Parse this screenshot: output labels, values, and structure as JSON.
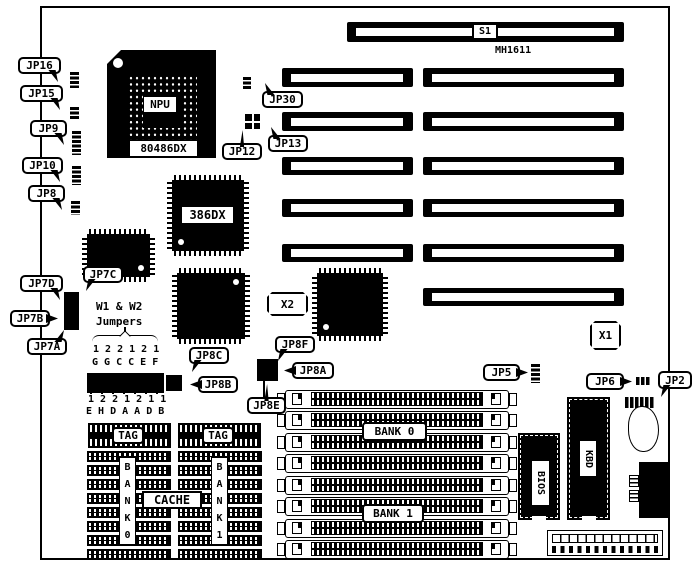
{
  "meta": {
    "description": "MH1611 486 motherboard jumper location diagram",
    "ink": "#000000",
    "paper": "#ffffff"
  },
  "board": {
    "name": "pcb-outline",
    "x": 40,
    "y": 6,
    "w": 630,
    "h": 554
  },
  "components": [
    {
      "type": "slot",
      "name": "slot-s1",
      "x": 347,
      "y": 22,
      "w": 277,
      "h": 20
    },
    {
      "type": "slot",
      "name": "slot-isa-left-1",
      "x": 282,
      "y": 68,
      "w": 131,
      "h": 19
    },
    {
      "type": "slot",
      "name": "slot-isa-right-1",
      "x": 423,
      "y": 68,
      "w": 201,
      "h": 19
    },
    {
      "type": "slot",
      "name": "slot-isa-left-2",
      "x": 282,
      "y": 112,
      "w": 131,
      "h": 19
    },
    {
      "type": "slot",
      "name": "slot-isa-right-2",
      "x": 423,
      "y": 112,
      "w": 201,
      "h": 19
    },
    {
      "type": "slot",
      "name": "slot-isa-left-3",
      "x": 282,
      "y": 157,
      "w": 131,
      "h": 18
    },
    {
      "type": "slot",
      "name": "slot-isa-right-3",
      "x": 423,
      "y": 157,
      "w": 201,
      "h": 18
    },
    {
      "type": "slot",
      "name": "slot-isa-left-4",
      "x": 282,
      "y": 199,
      "w": 131,
      "h": 18
    },
    {
      "type": "slot",
      "name": "slot-isa-right-4",
      "x": 423,
      "y": 199,
      "w": 201,
      "h": 18
    },
    {
      "type": "slot",
      "name": "slot-isa-left-5",
      "x": 282,
      "y": 244,
      "w": 131,
      "h": 18
    },
    {
      "type": "slot",
      "name": "slot-isa-right-5",
      "x": 423,
      "y": 244,
      "w": 201,
      "h": 18
    },
    {
      "type": "slot",
      "name": "slot-isa-right-6",
      "x": 423,
      "y": 288,
      "w": 201,
      "h": 18
    },
    {
      "type": "pga",
      "name": "chip-npu-socket",
      "x": 107,
      "y": 50,
      "w": 109,
      "h": 108
    },
    {
      "type": "tag",
      "name": "tag-npu",
      "label": "NPU",
      "x": 144,
      "y": 97,
      "w": 32,
      "h": 15,
      "border": 0,
      "fs": 11
    },
    {
      "type": "tag",
      "name": "tag-80486dx",
      "label": "80486DX",
      "x": 130,
      "y": 141,
      "w": 67,
      "h": 15,
      "border": 0,
      "fs": 11
    },
    {
      "type": "qfp",
      "name": "chip-386dx",
      "x": 172,
      "y": 180,
      "w": 72,
      "h": 71,
      "dot": "bl"
    },
    {
      "type": "tag",
      "name": "tag-386dx",
      "label": "386DX",
      "x": 182,
      "y": 207,
      "w": 51,
      "h": 16,
      "border": 0,
      "fs": 12
    },
    {
      "type": "qfp",
      "name": "chip-qfp-upper-left",
      "x": 87,
      "y": 234,
      "w": 63,
      "h": 43,
      "dot": "br"
    },
    {
      "type": "qfp",
      "name": "chip-qfp-center",
      "x": 177,
      "y": 273,
      "w": 68,
      "h": 66,
      "dot": "tr"
    },
    {
      "type": "qfp",
      "name": "chip-qfp-right",
      "x": 317,
      "y": 273,
      "w": 66,
      "h": 63,
      "dot": "bl"
    },
    {
      "type": "vstrip",
      "name": "jumper-jp16-pins",
      "x": 70,
      "y": 72,
      "w": 9,
      "h": 16
    },
    {
      "type": "vstrip",
      "name": "jumper-jp15-pins",
      "x": 70,
      "y": 107,
      "w": 9,
      "h": 13
    },
    {
      "type": "vstrip",
      "name": "jumper-jp9-pins",
      "x": 72,
      "y": 131,
      "w": 9,
      "h": 24
    },
    {
      "type": "vstrip",
      "name": "jumper-jp10-pins",
      "x": 72,
      "y": 166,
      "w": 9,
      "h": 19
    },
    {
      "type": "vstrip",
      "name": "jumper-jp8-pins",
      "x": 71,
      "y": 201,
      "w": 9,
      "h": 14
    },
    {
      "type": "vstrip",
      "name": "jumper-jp30-pins",
      "x": 243,
      "y": 77,
      "w": 8,
      "h": 13
    },
    {
      "type": "vstrip",
      "name": "jumper-jp5-pins",
      "x": 531,
      "y": 364,
      "w": 9,
      "h": 19
    },
    {
      "type": "hstrip",
      "name": "jumper-jp6-pins",
      "x": 636,
      "y": 377,
      "w": 15,
      "h": 8
    },
    {
      "type": "hstrip",
      "name": "jumper-jp2-pins",
      "x": 625,
      "y": 397,
      "w": 29,
      "h": 11
    },
    {
      "type": "block",
      "name": "jumper-block-jp7",
      "x": 64,
      "y": 292,
      "w": 15,
      "h": 38,
      "cols": 2,
      "rows": 6
    },
    {
      "type": "cross",
      "name": "jumper-jp12-jp13",
      "x": 245,
      "y": 114,
      "w": 15,
      "h": 15
    },
    {
      "type": "block",
      "name": "jumper-block-w1-w2",
      "x": 87,
      "y": 373,
      "w": 77,
      "h": 20,
      "cols": 12,
      "rows": 2
    },
    {
      "type": "block",
      "name": "jumper-block-jp8bc",
      "x": 166,
      "y": 375,
      "w": 16,
      "h": 16,
      "cols": 2,
      "rows": 2
    },
    {
      "type": "block",
      "name": "jumper-block-jp8aef",
      "x": 257,
      "y": 359,
      "w": 21,
      "h": 22,
      "cols": 2,
      "rows": 3
    },
    {
      "type": "bar",
      "name": "jp8e-pointer-line",
      "x": 263,
      "y": 380,
      "w": 2,
      "h": 18
    },
    {
      "type": "bar",
      "name": "jumpers-brace-stem",
      "x": 124,
      "y": 327,
      "w": 2,
      "h": 5
    },
    {
      "type": "text",
      "name": "text-w1-w2",
      "label": "W1 & W2",
      "x": 96,
      "y": 301,
      "fs": 11
    },
    {
      "type": "text",
      "name": "text-jumpers",
      "label": "Jumpers",
      "x": 96,
      "y": 316,
      "fs": 11
    },
    {
      "type": "brace",
      "name": "jumpers-brace",
      "x": 92,
      "y": 332,
      "w": 66,
      "h": 11
    },
    {
      "type": "text",
      "name": "text-top-pin-numbers",
      "label": "1 2 2 1 2 1",
      "x": 93,
      "y": 345,
      "fs": 10
    },
    {
      "type": "text",
      "name": "text-top-pin-letters",
      "label": "G G C C E F",
      "x": 92,
      "y": 358,
      "fs": 10
    },
    {
      "type": "ticks",
      "name": "w1-w2-tick-row",
      "x": 90,
      "y": 389,
      "w": 74,
      "h": 5
    },
    {
      "type": "text",
      "name": "text-bottom-pin-numbers",
      "label": "1 2 2 1 2 1 1",
      "x": 88,
      "y": 395,
      "fs": 10
    },
    {
      "type": "text",
      "name": "text-bottom-pin-letters",
      "label": "E H D A A D B",
      "x": 86,
      "y": 407,
      "fs": 10
    },
    {
      "type": "text",
      "name": "text-mh1611",
      "label": "MH1611",
      "x": 495,
      "y": 46,
      "fs": 10
    },
    {
      "type": "crystal",
      "name": "crystal-x2",
      "label": "X2",
      "x": 267,
      "y": 292,
      "w": 41,
      "h": 24
    },
    {
      "type": "crystal",
      "name": "crystal-x1",
      "label": "X1",
      "x": 590,
      "y": 321,
      "w": 31,
      "h": 29
    },
    {
      "type": "simm",
      "name": "simm-socket-1",
      "x": 277,
      "y": 390,
      "w": 240,
      "h": 19
    },
    {
      "type": "simm",
      "name": "simm-socket-2",
      "x": 277,
      "y": 411,
      "w": 240,
      "h": 19
    },
    {
      "type": "simm",
      "name": "simm-socket-3",
      "x": 277,
      "y": 433,
      "w": 240,
      "h": 19
    },
    {
      "type": "simm",
      "name": "simm-socket-4",
      "x": 277,
      "y": 454,
      "w": 240,
      "h": 19
    },
    {
      "type": "simm",
      "name": "simm-socket-5",
      "x": 277,
      "y": 476,
      "w": 240,
      "h": 19
    },
    {
      "type": "simm",
      "name": "simm-socket-6",
      "x": 277,
      "y": 497,
      "w": 240,
      "h": 19
    },
    {
      "type": "simm",
      "name": "simm-socket-7",
      "x": 277,
      "y": 519,
      "w": 240,
      "h": 19
    },
    {
      "type": "simm",
      "name": "simm-socket-8",
      "x": 277,
      "y": 540,
      "w": 240,
      "h": 19
    },
    {
      "type": "tag",
      "name": "tag-bank0",
      "label": "BANK 0",
      "x": 362,
      "y": 422,
      "w": 65,
      "h": 19,
      "border": 2,
      "round": 4,
      "fs": 11,
      "z": 20
    },
    {
      "type": "tag",
      "name": "tag-bank1",
      "label": "BANK 1",
      "x": 362,
      "y": 504,
      "w": 62,
      "h": 19,
      "border": 2,
      "round": 4,
      "fs": 11,
      "z": 20
    },
    {
      "type": "cachebar",
      "name": "cache-tag-chip-left",
      "x": 88,
      "y": 423,
      "w": 83,
      "h": 25
    },
    {
      "type": "cachebar",
      "name": "cache-tag-chip-right",
      "x": 178,
      "y": 423,
      "w": 83,
      "h": 25
    },
    {
      "type": "tag",
      "name": "tag-tag-left",
      "label": "TAG",
      "x": 112,
      "y": 427,
      "w": 32,
      "h": 17,
      "border": 2,
      "round": 4,
      "fs": 11,
      "z": 20
    },
    {
      "type": "tag",
      "name": "tag-tag-right",
      "label": "TAG",
      "x": 202,
      "y": 427,
      "w": 32,
      "h": 17,
      "border": 2,
      "round": 4,
      "fs": 11,
      "z": 20
    },
    {
      "type": "cachecol",
      "name": "cache-chips-bank0",
      "x": 87,
      "y": 451,
      "w": 84,
      "rows": 8,
      "rowh": 11,
      "pitch": 14
    },
    {
      "type": "cachecol",
      "name": "cache-chips-bank1",
      "x": 178,
      "y": 451,
      "w": 84,
      "rows": 8,
      "rowh": 11,
      "pitch": 14
    },
    {
      "type": "vtag",
      "name": "tag-bank0-vertical",
      "label": "BANK0",
      "x": 119,
      "y": 457,
      "w": 17,
      "h": 88
    },
    {
      "type": "vtag",
      "name": "tag-bank1-vertical",
      "label": "BANK1",
      "x": 211,
      "y": 457,
      "w": 17,
      "h": 88
    },
    {
      "type": "tag",
      "name": "tag-cache",
      "label": "CACHE",
      "x": 142,
      "y": 491,
      "w": 60,
      "h": 18,
      "border": 2,
      "fs": 12,
      "z": 21
    },
    {
      "type": "dip",
      "name": "chip-bios",
      "x": 518,
      "y": 433,
      "w": 42,
      "h": 87
    },
    {
      "type": "rtag",
      "name": "tag-bios",
      "label": "BIOS",
      "x": 532,
      "y": 461,
      "w": 17,
      "h": 44
    },
    {
      "type": "dip",
      "name": "chip-kbd",
      "x": 567,
      "y": 397,
      "w": 43,
      "h": 123
    },
    {
      "type": "rtag",
      "name": "tag-kbd",
      "label": "KBD",
      "x": 580,
      "y": 441,
      "w": 16,
      "h": 35
    },
    {
      "type": "din",
      "name": "keyboard-din-connector",
      "x": 628,
      "y": 406,
      "w": 31,
      "h": 46
    },
    {
      "type": "power",
      "name": "power-connector-block",
      "x": 639,
      "y": 462,
      "w": 31,
      "h": 56
    },
    {
      "type": "pconn",
      "name": "power-pin-header",
      "x": 547,
      "y": 530,
      "w": 116,
      "h": 26
    },
    {
      "type": "tag",
      "name": "tag-s1",
      "label": "S1",
      "x": 472,
      "y": 23,
      "w": 26,
      "h": 17,
      "border": 2,
      "fs": 10,
      "z": 20
    },
    {
      "type": "callout",
      "name": "callout-jp16",
      "label": "JP16",
      "x": 18,
      "y": 57,
      "w": 43,
      "h": 17,
      "tail": "br"
    },
    {
      "type": "callout",
      "name": "callout-jp15",
      "label": "JP15",
      "x": 20,
      "y": 85,
      "w": 43,
      "h": 17,
      "tail": "br"
    },
    {
      "type": "callout",
      "name": "callout-jp9",
      "label": "JP9",
      "x": 30,
      "y": 120,
      "w": 37,
      "h": 17,
      "tail": "br"
    },
    {
      "type": "callout",
      "name": "callout-jp10",
      "label": "JP10",
      "x": 22,
      "y": 157,
      "w": 41,
      "h": 17,
      "tail": "br"
    },
    {
      "type": "callout",
      "name": "callout-jp8",
      "label": "JP8",
      "x": 28,
      "y": 185,
      "w": 37,
      "h": 17,
      "tail": "br"
    },
    {
      "type": "callout",
      "name": "callout-jp7d",
      "label": "JP7D",
      "x": 20,
      "y": 275,
      "w": 43,
      "h": 17,
      "tail": "br"
    },
    {
      "type": "callout",
      "name": "callout-jp7c",
      "label": "JP7C",
      "x": 83,
      "y": 266,
      "w": 40,
      "h": 17,
      "tail": "bl"
    },
    {
      "type": "callout",
      "name": "callout-jp7b",
      "label": "JP7B",
      "x": 10,
      "y": 310,
      "w": 40,
      "h": 17,
      "tail": "r"
    },
    {
      "type": "callout",
      "name": "callout-jp7a",
      "label": "JP7A",
      "x": 27,
      "y": 338,
      "w": 40,
      "h": 17,
      "tail": "tr"
    },
    {
      "type": "callout",
      "name": "callout-jp30",
      "label": "JP30",
      "x": 262,
      "y": 91,
      "w": 41,
      "h": 17,
      "tail": "tl"
    },
    {
      "type": "callout",
      "name": "callout-jp12",
      "label": "JP12",
      "x": 222,
      "y": 143,
      "w": 40,
      "h": 17,
      "tail": "t"
    },
    {
      "type": "callout",
      "name": "callout-jp13",
      "label": "JP13",
      "x": 268,
      "y": 135,
      "w": 40,
      "h": 17,
      "tail": "tl"
    },
    {
      "type": "callout",
      "name": "callout-jp8c",
      "label": "JP8C",
      "x": 189,
      "y": 347,
      "w": 40,
      "h": 17,
      "tail": "bl"
    },
    {
      "type": "callout",
      "name": "callout-jp8b",
      "label": "JP8B",
      "x": 198,
      "y": 376,
      "w": 40,
      "h": 17,
      "tail": "l"
    },
    {
      "type": "callout",
      "name": "callout-jp8f",
      "label": "JP8F",
      "x": 275,
      "y": 336,
      "w": 40,
      "h": 17,
      "tail": "bl"
    },
    {
      "type": "callout",
      "name": "callout-jp8a",
      "label": "JP8A",
      "x": 292,
      "y": 362,
      "w": 42,
      "h": 17,
      "tail": "l"
    },
    {
      "type": "callout",
      "name": "callout-jp8e",
      "label": "JP8E",
      "x": 247,
      "y": 397,
      "w": 39,
      "h": 17,
      "tail": "t"
    },
    {
      "type": "callout",
      "name": "callout-jp5",
      "label": "JP5",
      "x": 483,
      "y": 364,
      "w": 37,
      "h": 17,
      "tail": "r"
    },
    {
      "type": "callout",
      "name": "callout-jp6",
      "label": "JP6",
      "x": 586,
      "y": 373,
      "w": 38,
      "h": 17,
      "tail": "r"
    },
    {
      "type": "callout",
      "name": "callout-jp2",
      "label": "JP2",
      "x": 658,
      "y": 371,
      "w": 34,
      "h": 18,
      "tail": "bl"
    }
  ]
}
